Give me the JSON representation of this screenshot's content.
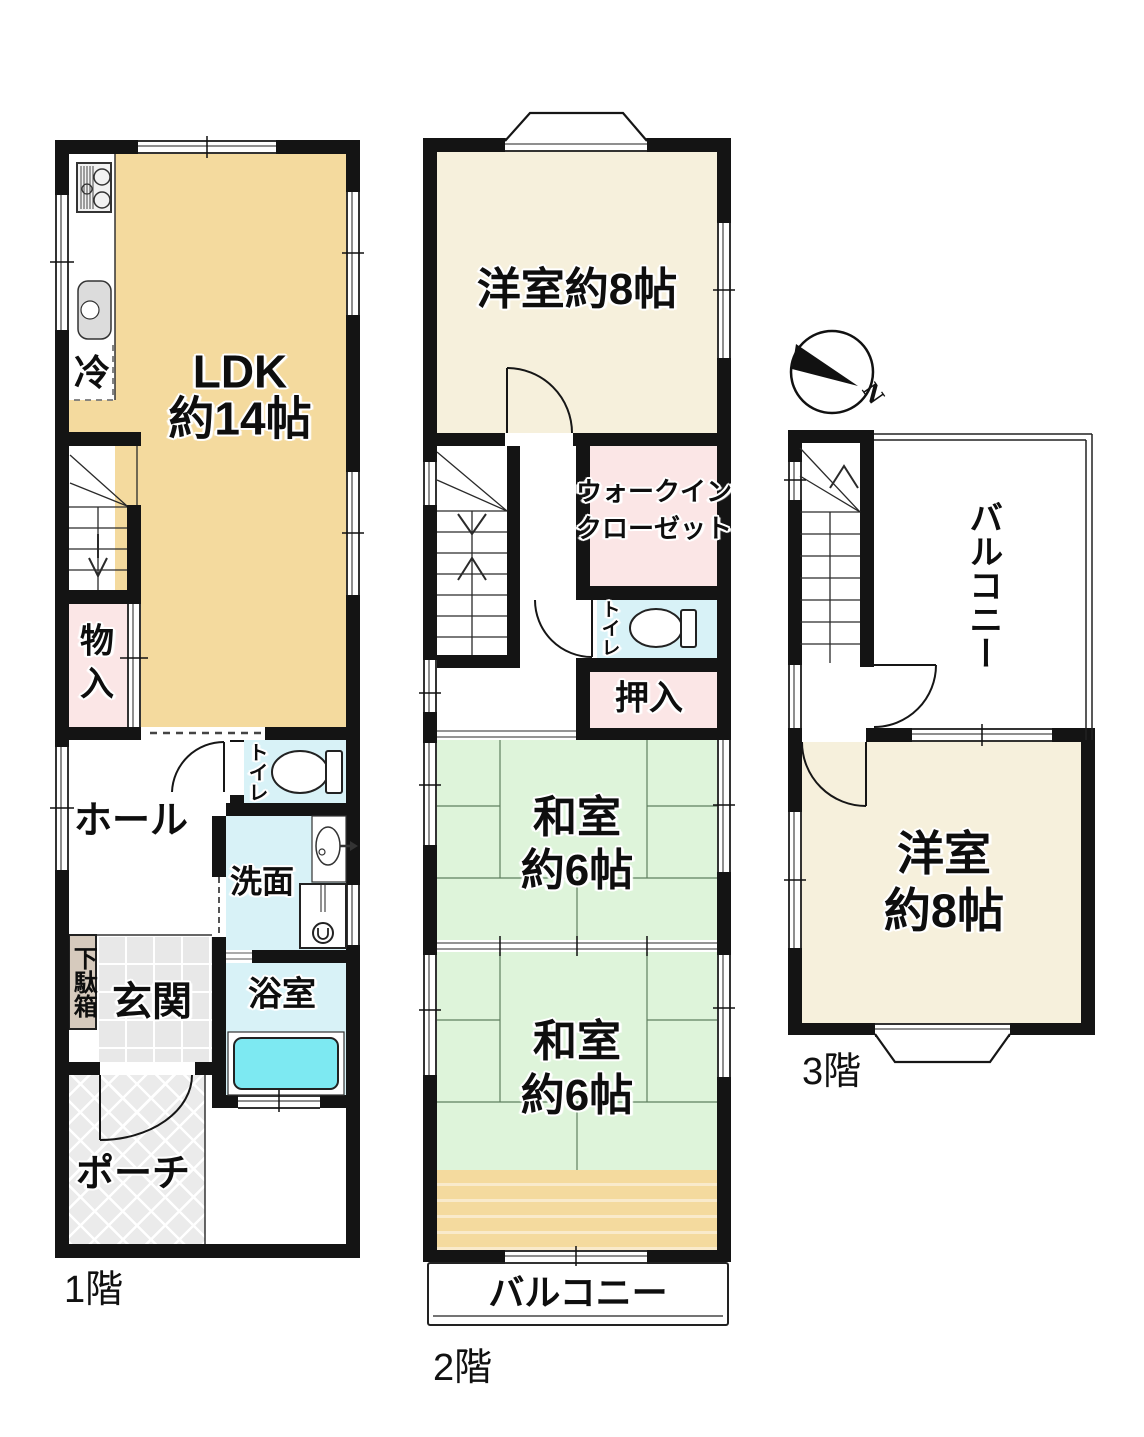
{
  "colors": {
    "wall": "#141414",
    "ldk": "#F4DA9E",
    "western_room": "#F6F0DC",
    "tatami_room": "#DEF4DA",
    "closet_pink": "#FBE6E6",
    "wet_area_cyan": "#D8F2F7",
    "bathtub": "#7DE9F2",
    "entrance_tile": "#E8E8E8",
    "porch": "#EAEAEA",
    "shoe_cabinet": "#D6CABD",
    "wood_strip": "#F4DA9E"
  },
  "floor1": {
    "label": "1階",
    "ldk_line1": "LDK",
    "ldk_line2": "約14帖",
    "fridge": "冷",
    "storage": "物入",
    "hall": "ホール",
    "toilet": "トイレ",
    "washroom": "洗面",
    "bathroom": "浴室",
    "shoe_cabinet": "下駄箱",
    "entrance": "玄関",
    "porch": "ポーチ"
  },
  "floor2": {
    "label": "2階",
    "western_room": "洋室約8帖",
    "walkin_line1": "ウォークイン",
    "walkin_line2": "クローゼット",
    "toilet": "トイレ",
    "oshiire": "押入",
    "tatami_a_line1": "和室",
    "tatami_a_line2": "約6帖",
    "tatami_b_line1": "和室",
    "tatami_b_line2": "約6帖",
    "balcony": "バルコニー"
  },
  "floor3": {
    "label": "3階",
    "balcony": "バルコニー",
    "western_line1": "洋室",
    "western_line2": "約8帖",
    "compass_north": "N"
  }
}
